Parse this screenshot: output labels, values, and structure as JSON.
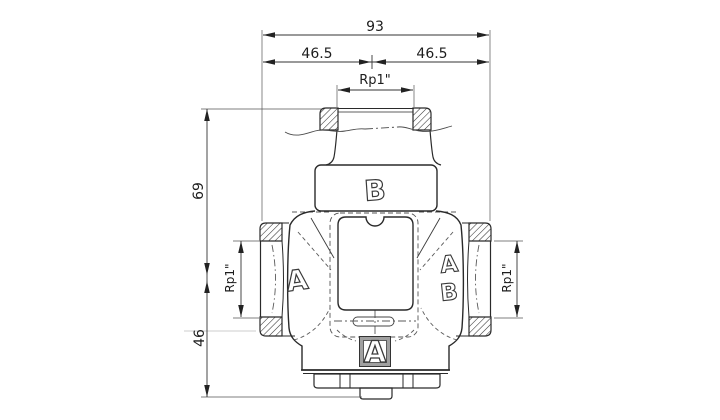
{
  "drawing": {
    "type": "valve-technical-drawing-front-view",
    "dims": {
      "overall_width": "93",
      "half_width_left": "46.5",
      "half_width_right": "46.5",
      "top_thread": "Rp1\"",
      "height_top_to_port_center": "69",
      "height_port_center_to_bottom": "46",
      "left_thread": "Rp1\"",
      "right_thread": "Rp1\""
    },
    "ports": {
      "top": "B",
      "left": "A",
      "right_upper": "A",
      "right_lower": "B",
      "bottom": "A"
    },
    "colors": {
      "object_line": "#2a2a2a",
      "dimension_line": "#333333",
      "extension_line": "#555555",
      "hatch": "#333333",
      "background": "#ffffff"
    }
  }
}
